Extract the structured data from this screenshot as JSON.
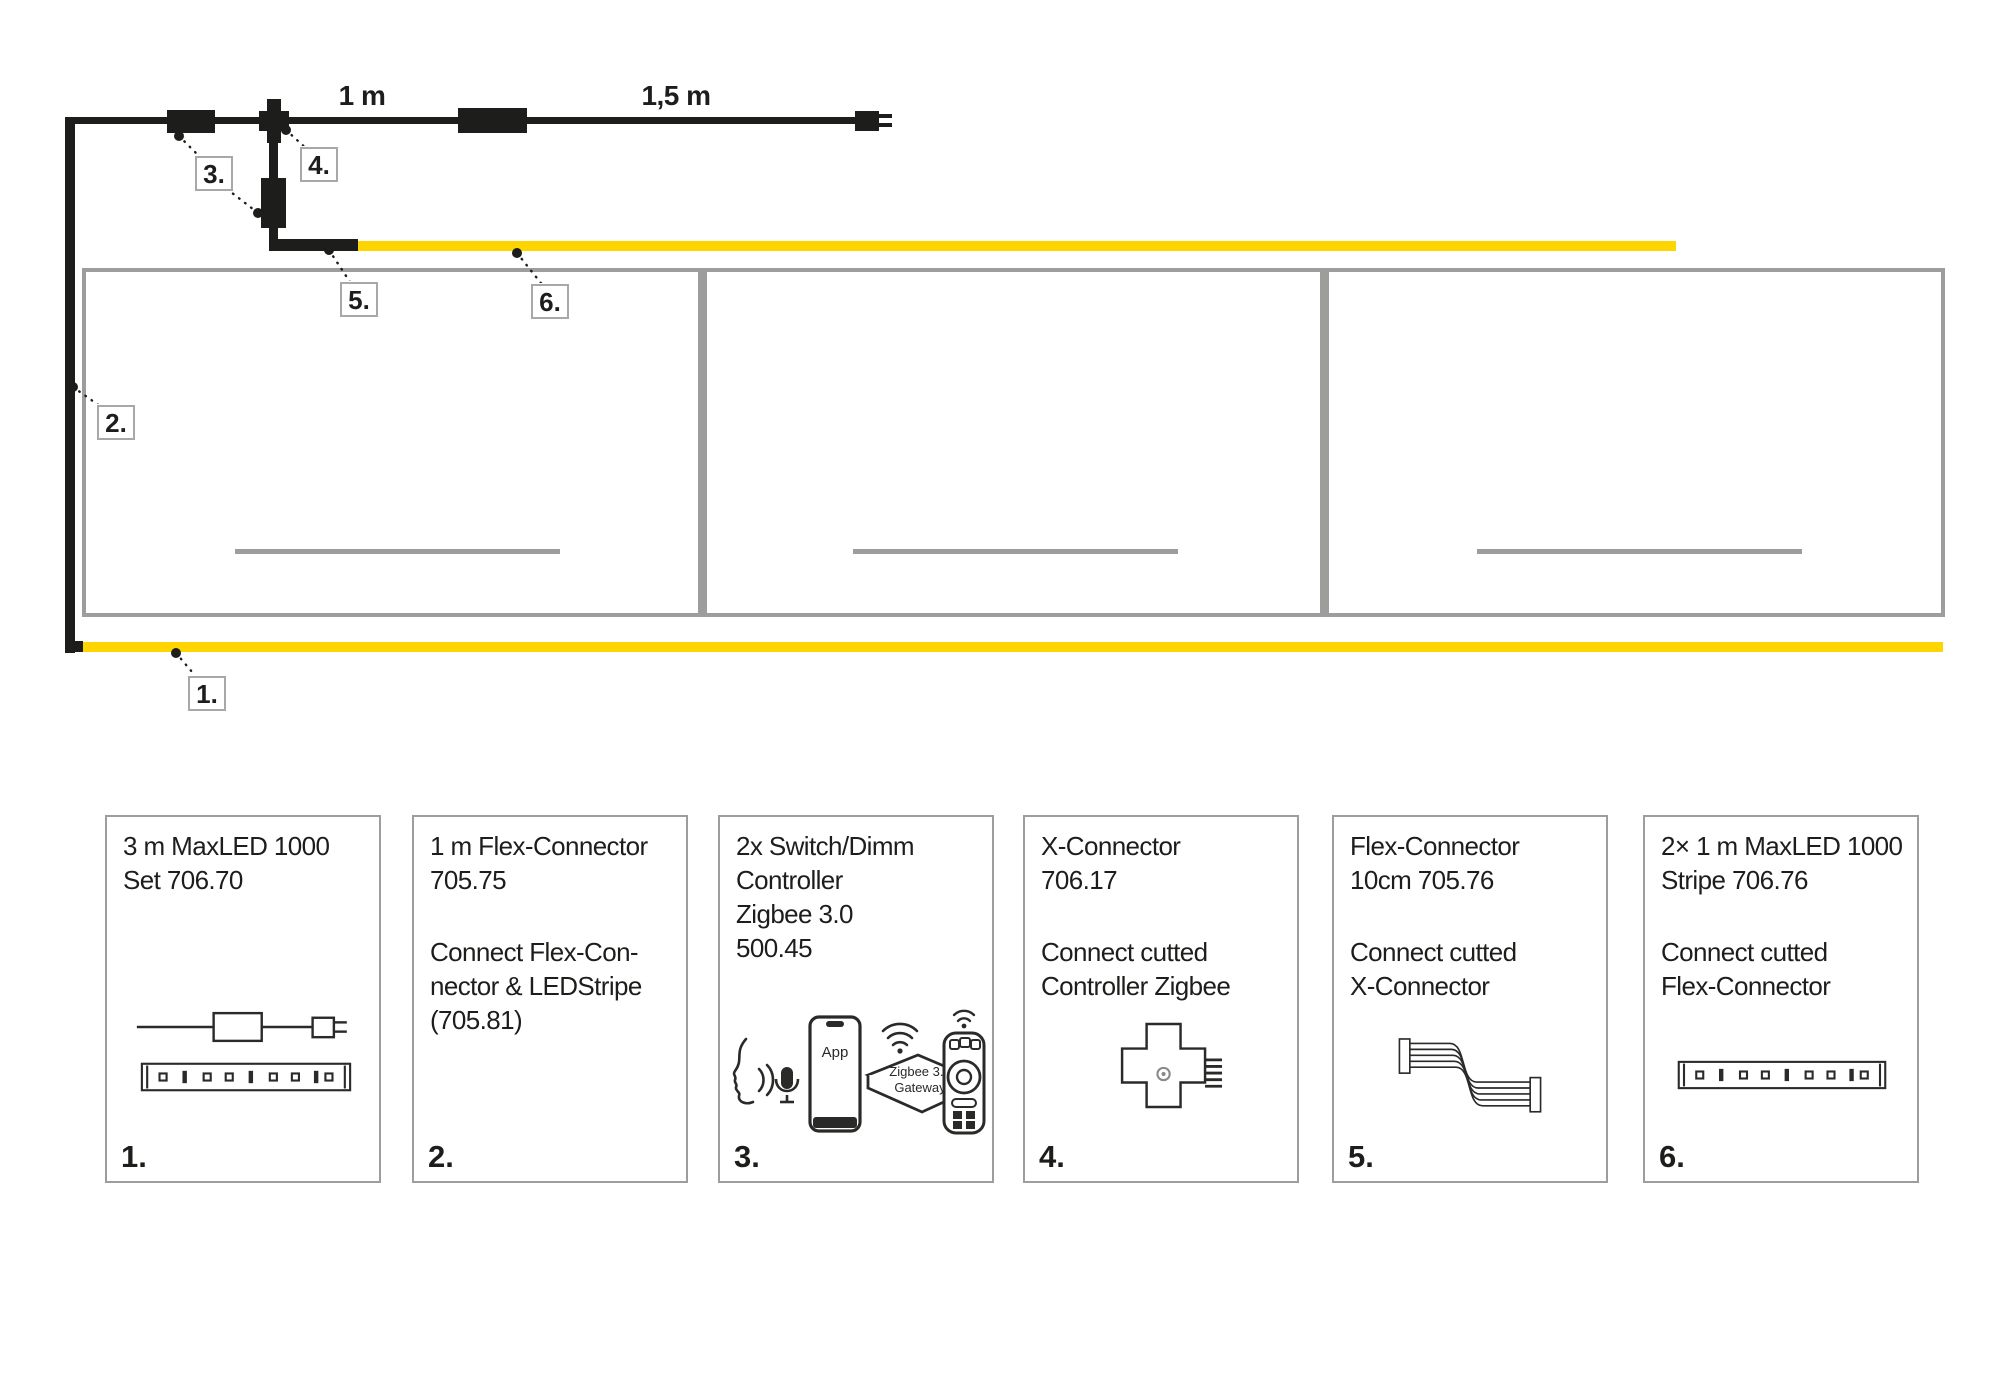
{
  "diagram": {
    "measurement_1": "1 m",
    "measurement_2": "1,5 m",
    "callout_1": "1.",
    "callout_2": "2.",
    "callout_3": "3.",
    "callout_4": "4.",
    "callout_5": "5.",
    "callout_6": "6."
  },
  "gateway": {
    "app": "App",
    "line1": "Zigbee 3.0",
    "line2": "Gateway"
  },
  "legend": {
    "items": [
      {
        "num": "1.",
        "title": "3 m MaxLED 1000\nSet 706.70",
        "desc": ""
      },
      {
        "num": "2.",
        "title": "1 m Flex-Connector\n705.75",
        "desc": "Connect Flex-Con-\nnector & LEDStripe\n(705.81)"
      },
      {
        "num": "3.",
        "title": "2x Switch/Dimm\nController\nZigbee 3.0\n500.45",
        "desc": ""
      },
      {
        "num": "4.",
        "title": "X-Connector\n706.17",
        "desc": "Connect cutted\nController Zigbee"
      },
      {
        "num": "5.",
        "title": "Flex-Connector\n10cm 705.76",
        "desc": "Connect cutted\nX-Connector"
      },
      {
        "num": "6.",
        "title": "2× 1 m MaxLED 1000\nStripe 706.76",
        "desc": "Connect cutted\nFlex-Connector"
      }
    ]
  },
  "icons": {
    "legend_1": [
      "power-cable-driver-plug-icon",
      "led-stripe-icon"
    ],
    "legend_3": [
      "voice-control-icon",
      "microphone-icon",
      "smartphone-app-icon",
      "zigbee-gateway-icon",
      "wifi-icon",
      "remote-control-icon"
    ],
    "legend_4": [
      "x-connector-icon"
    ],
    "legend_5": [
      "flex-ribbon-connector-icon"
    ],
    "legend_6": [
      "led-stripe-icon"
    ]
  },
  "colors": {
    "strip_yellow": "#FFD500",
    "cable_black": "#1d1d1b",
    "cabinet_gray": "#9d9d9c"
  }
}
